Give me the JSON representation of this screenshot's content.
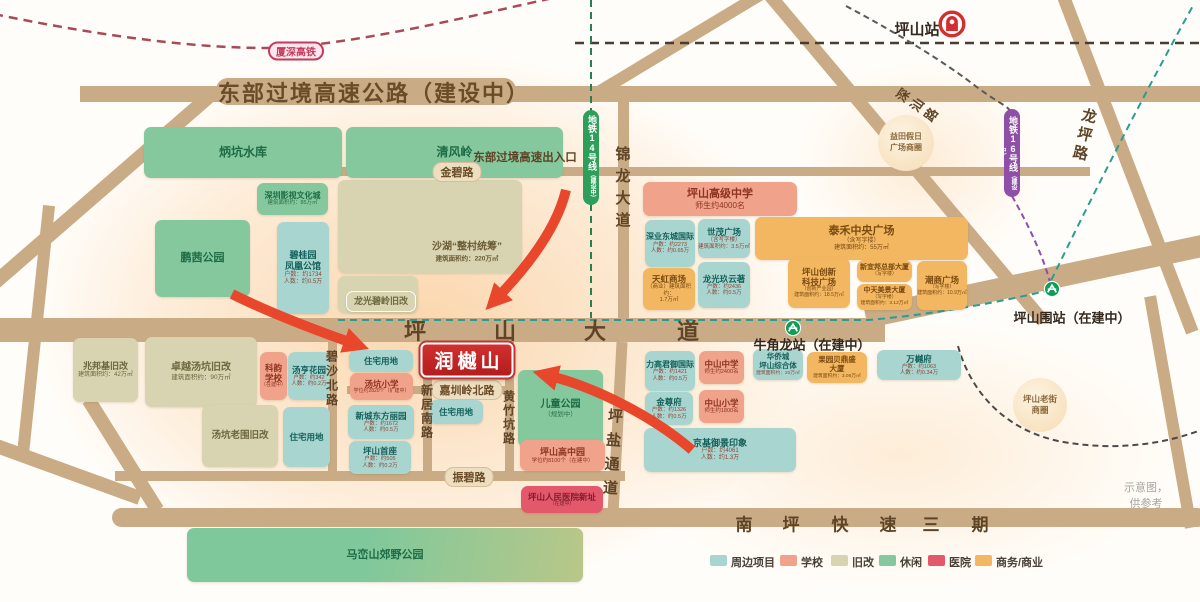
{
  "disclaimer": "示意图，供参考",
  "project": {
    "name": "润樾山",
    "x": 467,
    "y": 360
  },
  "category_colors": {
    "project": {
      "bg": "#a9d5d1",
      "text": "#14605a",
      "sub": "#8c4636"
    },
    "school": {
      "bg": "#f0a28b",
      "text": "#8d3322",
      "sub": "#8d3322"
    },
    "redev": {
      "bg": "#d8d3b0",
      "text": "#6e683f",
      "sub": "#6e683f"
    },
    "leisure": {
      "bg": "#85c89e",
      "text": "#1f6b45",
      "sub": "#2b6e49"
    },
    "hospital": {
      "bg": "#e3586b",
      "text": "#7c1f2d",
      "sub": "#7c1f2d"
    },
    "commerce": {
      "bg": "#f2b760",
      "text": "#7a4a12",
      "sub": "#7a4a12"
    }
  },
  "blocks": [
    {
      "t": "",
      "c": "redev",
      "x": 338,
      "y": 180,
      "w": 184,
      "h": 93
    },
    {
      "t": "",
      "c": "redev",
      "x": 338,
      "y": 276,
      "w": 80,
      "h": 37
    },
    {
      "t": "炳坑水库",
      "c": "leisure",
      "x": 144,
      "y": 127,
      "w": 198,
      "h": 51,
      "ts": 12
    },
    {
      "t": "清风岭",
      "c": "leisure",
      "x": 346,
      "y": 127,
      "w": 217,
      "h": 51,
      "ts": 12
    },
    {
      "t": "深圳影视文化城",
      "c": "leisure",
      "x": 257,
      "y": 183,
      "w": 71,
      "h": 32,
      "ts": 8,
      "sub": [
        "建筑面积约：85万㎡"
      ],
      "ss": 5.5
    },
    {
      "t": "鹏茜公园",
      "c": "leisure",
      "x": 155,
      "y": 220,
      "w": 95,
      "h": 77,
      "ts": 11
    },
    {
      "t": "碧桂园\n凤凰公馆",
      "c": "project",
      "x": 277,
      "y": 222,
      "w": 52,
      "h": 92,
      "ts": 9,
      "sub": [
        "户数：约1734",
        "人数：约0.5万"
      ],
      "ss": 6
    },
    {
      "t": "龙光碧岭旧改",
      "c": "redev",
      "x": 346,
      "y": 291,
      "w": 70,
      "h": 21,
      "ts": 9,
      "wb": true
    },
    {
      "t": "兆邦基旧改",
      "c": "redev",
      "x": 73,
      "y": 338,
      "w": 65,
      "h": 64,
      "ts": 9,
      "sub": [
        "建筑面积约：42万㎡"
      ],
      "ss": 6
    },
    {
      "t": "卓越汤坑旧改",
      "c": "redev",
      "x": 145,
      "y": 337,
      "w": 112,
      "h": 70,
      "ts": 10,
      "sub": [
        "建筑面积约：90万㎡"
      ],
      "ss": 6.5
    },
    {
      "t": "科韵\n学校",
      "c": "school",
      "x": 260,
      "y": 352,
      "w": 27,
      "h": 48,
      "ts": 8.5,
      "sub": [
        "（在建中）"
      ],
      "ss": 5
    },
    {
      "t": "汤亨花园",
      "c": "project",
      "x": 288,
      "y": 352,
      "w": 42,
      "h": 48,
      "ts": 8.5,
      "sub": [
        "户数：约342",
        "人数：约0.2万"
      ],
      "ss": 5.5
    },
    {
      "t": "汤坑老围旧改",
      "c": "redev",
      "x": 202,
      "y": 405,
      "w": 76,
      "h": 62,
      "ts": 9.5
    },
    {
      "t": "住宅用地",
      "c": "project",
      "x": 283,
      "y": 407,
      "w": 47,
      "h": 60,
      "ts": 8.5
    },
    {
      "t": "住宅用地",
      "c": "project",
      "x": 349,
      "y": 350,
      "w": 64,
      "h": 22,
      "ts": 8.5
    },
    {
      "t": "汤坑小学",
      "c": "school",
      "x": 350,
      "y": 373,
      "w": 63,
      "h": 27,
      "ts": 8.5,
      "sub": [
        "学位约2820个（扩建中）"
      ],
      "ss": 5
    },
    {
      "t": "新城东方丽园",
      "c": "project",
      "x": 348,
      "y": 405,
      "w": 66,
      "h": 34,
      "ts": 8.5,
      "sub": [
        "户数：约1672",
        "人数：约0.5万"
      ],
      "ss": 5.5
    },
    {
      "t": "坪山首座",
      "c": "project",
      "x": 349,
      "y": 441,
      "w": 62,
      "h": 33,
      "ts": 8.5,
      "sub": [
        "户数：约505",
        "人数：约0.2万"
      ],
      "ss": 5.5
    },
    {
      "t": "住宅用地",
      "c": "project",
      "x": 429,
      "y": 400,
      "w": 54,
      "h": 24,
      "ts": 8.5
    },
    {
      "t": "儿童公园",
      "c": "leisure",
      "x": 518,
      "y": 370,
      "w": 85,
      "h": 77,
      "ts": 10,
      "sub": [
        "（规划中）"
      ],
      "ss": 6.5
    },
    {
      "t": "坪山高中园",
      "c": "school",
      "x": 520,
      "y": 440,
      "w": 85,
      "h": 31,
      "ts": 9,
      "sub": [
        "学位约8100个（在建中）"
      ],
      "ss": 5.5
    },
    {
      "t": "坪山人民医院新址",
      "c": "hospital",
      "x": 521,
      "y": 486,
      "w": 82,
      "h": 27,
      "ts": 8.5,
      "sub": [
        "（在建中）"
      ],
      "ss": 5
    },
    {
      "t": "马峦山郊野公园",
      "c": "leisure",
      "x": 187,
      "y": 528,
      "w": 396,
      "h": 54,
      "ts": 11,
      "bg": "linear-gradient(100deg,#7fc89c 45%,#b9c788)"
    },
    {
      "t": "坪山高级中学",
      "c": "school",
      "x": 643,
      "y": 182,
      "w": 154,
      "h": 34,
      "ts": 11,
      "sub": [
        "师生约4000名"
      ],
      "ss": 8
    },
    {
      "t": "深业东城国际",
      "c": "project",
      "x": 645,
      "y": 220,
      "w": 50,
      "h": 47,
      "ts": 8,
      "sub": [
        "户数：约2273",
        "人数：约0.65万"
      ],
      "ss": 5.5
    },
    {
      "t": "世茂广场",
      "c": "project",
      "x": 698,
      "y": 219,
      "w": 52,
      "h": 39,
      "ts": 8.5,
      "sub": [
        "（含写字楼）",
        "建筑面积约：3.5万㎡"
      ],
      "ss": 5.5
    },
    {
      "t": "天虹商场",
      "c": "commerce",
      "x": 643,
      "y": 268,
      "w": 52,
      "h": 42,
      "ts": 8.5,
      "sub": [
        "（商业）建筑面积约：",
        "1.7万㎡"
      ],
      "ss": 5.5
    },
    {
      "t": "龙光玖云著",
      "c": "project",
      "x": 698,
      "y": 262,
      "w": 52,
      "h": 46,
      "ts": 8.5,
      "sub": [
        "户数：约2436",
        "人数：约0.5万"
      ],
      "ss": 5.5
    },
    {
      "t": "泰禾中央广场",
      "c": "commerce",
      "x": 755,
      "y": 217,
      "w": 213,
      "h": 43,
      "ts": 11,
      "sub": [
        "（含写字楼）",
        "建筑面积约：55万㎡"
      ],
      "ss": 6
    },
    {
      "t": "坪山创新\n科技广场",
      "c": "commerce",
      "x": 788,
      "y": 258,
      "w": 62,
      "h": 50,
      "ts": 8.5,
      "sub": [
        "（创新产业园）",
        "建筑面积约：18.5万㎡"
      ],
      "ss": 5
    },
    {
      "t": "新宜邦总部大厦",
      "c": "commerce",
      "x": 857,
      "y": 260,
      "w": 55,
      "h": 22,
      "ts": 7,
      "sub": [
        "（写字楼）"
      ],
      "ss": 5
    },
    {
      "t": "中天美景大厦",
      "c": "commerce",
      "x": 857,
      "y": 284,
      "w": 55,
      "h": 26,
      "ts": 7,
      "sub": [
        "（写字楼）",
        "建筑面积约：3.12万㎡"
      ],
      "ss": 4.8
    },
    {
      "t": "潮商广场",
      "c": "commerce",
      "x": 917,
      "y": 261,
      "w": 50,
      "h": 49,
      "ts": 8.5,
      "sub": [
        "（写字楼）",
        "建筑面积约：10.9万㎡"
      ],
      "ss": 5
    },
    {
      "t": "力高君御国际",
      "c": "project",
      "x": 645,
      "y": 351,
      "w": 50,
      "h": 40,
      "ts": 8,
      "sub": [
        "户数：约1421",
        "人数：约0.5万"
      ],
      "ss": 5.5
    },
    {
      "t": "中山中学",
      "c": "school",
      "x": 699,
      "y": 351,
      "w": 45,
      "h": 33,
      "ts": 8.5,
      "sub": [
        "师生约2400名"
      ],
      "ss": 5.5
    },
    {
      "t": "华侨城\n坪山综合体",
      "c": "project",
      "x": 753,
      "y": 349,
      "w": 50,
      "h": 31,
      "ts": 7.5,
      "sub": [
        "建筑面积约：20万㎡"
      ],
      "ss": 4.8
    },
    {
      "t": "果园贝鼎盛\n大厦",
      "c": "commerce",
      "x": 807,
      "y": 352,
      "w": 60,
      "h": 31,
      "ts": 7.5,
      "sub": [
        "建筑面积约：3.06万㎡"
      ],
      "ss": 4.8
    },
    {
      "t": "万樾府",
      "c": "project",
      "x": 877,
      "y": 350,
      "w": 84,
      "h": 30,
      "ts": 8.5,
      "sub": [
        "户数：约1063",
        "人数：约0.34万"
      ],
      "ss": 5.5
    },
    {
      "t": "金尊府",
      "c": "project",
      "x": 645,
      "y": 392,
      "w": 48,
      "h": 33,
      "ts": 8.5,
      "sub": [
        "户数：约1326",
        "人数：约0.5万"
      ],
      "ss": 5.5
    },
    {
      "t": "中山小学",
      "c": "school",
      "x": 699,
      "y": 390,
      "w": 45,
      "h": 33,
      "ts": 8.5,
      "sub": [
        "师生约1800名"
      ],
      "ss": 5.5
    },
    {
      "t": "京基御景印象",
      "c": "project",
      "x": 644,
      "y": 428,
      "w": 152,
      "h": 44,
      "ts": 9,
      "sub": [
        "户数：约4061",
        "人数：约1.3万"
      ],
      "ss": 6
    }
  ],
  "road_labels": {
    "big": [
      {
        "t": "东部过境高速公路（建设中）",
        "x": 374,
        "y": 92,
        "size": 22,
        "ls": 2,
        "color": "#6b4c28"
      },
      {
        "t": "东部过境高速出入口",
        "x": 525,
        "y": 157,
        "size": 11.5,
        "color": "#5d4326"
      }
    ],
    "capsules": [
      {
        "t": "金碧路",
        "x": 457,
        "y": 172,
        "size": 11
      },
      {
        "t": "振碧路",
        "x": 469,
        "y": 477,
        "size": 11
      },
      {
        "t": "嘉圳岭北路",
        "x": 467,
        "y": 390,
        "size": 11
      }
    ],
    "spread": [
      {
        "t": "坪山大道",
        "xs": [
          415,
          505,
          595,
          688
        ],
        "y": 330,
        "size": 22
      },
      {
        "t": "南坪快速三期",
        "xs": [
          744,
          791,
          840,
          888,
          931,
          980
        ],
        "y": 523,
        "size": 17
      }
    ],
    "vertical": [
      {
        "t": "锦龙大道",
        "x": 622,
        "y": 146,
        "size": 15,
        "ls": 7,
        "rot": 0
      },
      {
        "t": "碧沙北路",
        "x": 332,
        "y": 350,
        "size": 12,
        "ls": 2.5,
        "rot": 0
      },
      {
        "t": "新居南路",
        "x": 427,
        "y": 384,
        "size": 12,
        "ls": 2,
        "rot": 0
      },
      {
        "t": "黄竹坑路",
        "x": 509,
        "y": 390,
        "size": 12,
        "ls": 2,
        "rot": 0
      },
      {
        "t": "坪盐通道",
        "x": 615,
        "y": 408,
        "size": 15,
        "ls": 9,
        "rot": 4
      },
      {
        "t": "龙坪路",
        "x": 1090,
        "y": 108,
        "size": 15,
        "ls": 4,
        "rot": 13
      },
      {
        "t": "深汕路",
        "x": 897,
        "y": 92,
        "size": 13,
        "ls": 4,
        "rot": -55
      }
    ]
  },
  "floating_labels": [
    {
      "t": "沙湖“整村统筹”",
      "x": 467,
      "y": 250,
      "size": 10,
      "color": "#6b5a35",
      "sub": "建筑面积约：220万㎡",
      "subsize": 6.5
    }
  ],
  "stations": [
    {
      "n": "station-pingshan",
      "t": "坪山站",
      "x": 917,
      "y": 29,
      "size": 15,
      "icon": "rail",
      "ix": 952,
      "iy": 24
    },
    {
      "n": "station-pingshanwei",
      "t": "坪山围站（在建中）",
      "x": 1072,
      "y": 317,
      "size": 13,
      "icon": "metro",
      "ix": 1052,
      "iy": 289
    },
    {
      "n": "station-niujiaolong",
      "t": "牛角龙站（在建中）",
      "x": 812,
      "y": 344,
      "size": 13,
      "icon": "metro",
      "ix": 793,
      "iy": 328
    }
  ],
  "transit": {
    "hsr_badge": {
      "t": "厦深高铁",
      "x": 296,
      "y": 51
    },
    "metro_capsules": [
      {
        "t": "地铁14号线",
        "note": "（建设中）",
        "x": 591,
        "y": 110,
        "w": 16,
        "h": 95,
        "color": "#2e9e5b"
      },
      {
        "t": "地铁16号线",
        "note": "（建设中）",
        "x": 1012,
        "y": 109,
        "w": 16,
        "h": 88,
        "color": "#8f4fa8"
      }
    ]
  },
  "circles": [
    {
      "t": "益田假日\n广场商圈",
      "x": 906,
      "y": 143,
      "r": 28,
      "size": 8
    },
    {
      "t": "坪山老街\n商圈",
      "x": 1040,
      "y": 405,
      "r": 27,
      "size": 8.5
    }
  ],
  "legend": {
    "y": 555,
    "items": [
      {
        "t": "周边项目",
        "c": "project",
        "x": 710
      },
      {
        "t": "学校",
        "c": "school",
        "x": 780
      },
      {
        "t": "旧改",
        "c": "redev",
        "x": 831
      },
      {
        "t": "休闲",
        "c": "leisure",
        "x": 879
      },
      {
        "t": "医院",
        "c": "hospital",
        "x": 928
      },
      {
        "t": "商务/商业",
        "c": "commerce",
        "x": 975
      }
    ]
  }
}
